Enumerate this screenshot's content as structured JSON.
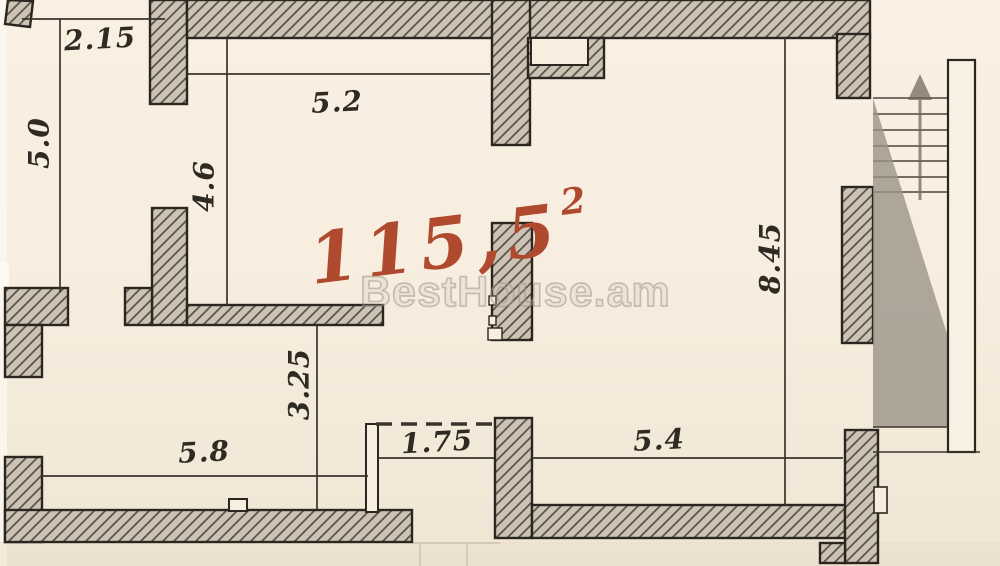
{
  "plan": {
    "watermark": "BestHouse.am",
    "area": {
      "value": "115,5",
      "superscript": "2"
    },
    "dimensions": {
      "top_left_width": "2.15",
      "left_height": "5.0",
      "top_room_width": "5.2",
      "top_room_depth": "4.6",
      "bottom_left_room_depth": "3.25",
      "bottom_left_room_width": "5.8",
      "opening_width": "1.75",
      "bottom_right_room_width": "5.4",
      "right_room_height": "8.45"
    },
    "colors": {
      "paper": "#f7eddf",
      "wall_fill": "#cdc3b4",
      "hatch_line": "#5a5348",
      "outline": "#2b2620",
      "dimension_line": "#3b342c",
      "area_ink": "#b04a2e",
      "watermark_gray": "#b8b1a5",
      "stair_shadow": "#9c9488"
    }
  }
}
